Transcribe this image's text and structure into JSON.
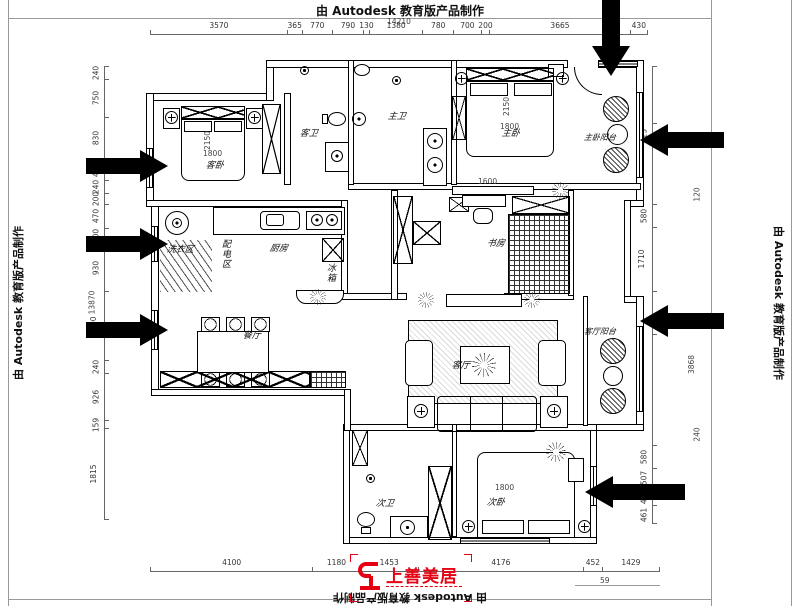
{
  "banner": {
    "top": "由 Autodesk 教育版产品制作",
    "left": "由 Autodesk 教育版产品制作",
    "right": "由 Autodesk 教育版产品制作",
    "bottom": "由 Autodesk 教育版产品制作"
  },
  "logo": {
    "text": "上善美居",
    "color": "#e60012"
  },
  "rooms": {
    "guest_bedroom": "客卧",
    "guest_bath": "客卫",
    "master_bath": "主卫",
    "master_bedroom": "主卧",
    "master_balcony": "主卧阳台",
    "study": "书房",
    "power_area": "配电区",
    "laundry": "洗衣区",
    "kitchen": "厨房",
    "fridge": "冰箱",
    "dining": "餐厅",
    "living": "客厅",
    "living_balcony": "客厅阳台",
    "second_bath": "次卫",
    "second_bedroom": "次卧"
  },
  "dims": {
    "top_total": "14210",
    "top": [
      "3570",
      "365",
      "770",
      "790",
      "130",
      "1380",
      "780",
      "700",
      "200",
      "3665",
      "430"
    ],
    "bottom": [
      "4100",
      "1180",
      "1453",
      "4176",
      "452",
      "1429"
    ],
    "bottom_sub": "59",
    "left_total": "13870",
    "left": [
      "240",
      "750",
      "830",
      "410",
      "240",
      "200",
      "470",
      "300",
      "930",
      "1390",
      "240",
      "926",
      "159",
      "1815"
    ],
    "right": [
      "1530",
      "623",
      "1530",
      "580",
      "1710",
      "1145",
      "3010",
      "580",
      "507",
      "451",
      "461"
    ],
    "right_outer": {
      "a": "120",
      "b": "3868",
      "c": "240"
    }
  },
  "furniture_dims": {
    "guest_bed_l": "2150",
    "guest_bed_w": "1800",
    "master_bed_l": "2150",
    "master_bed_w": "1800",
    "tv_cabinet": "1600",
    "second_bed_w": "1800"
  },
  "icons": {
    "plant-icon": "css-starburst",
    "potted-plant-icon": "css-hatched-circle",
    "flower-icon": "css-cross-circle",
    "ceiling-light-icon": "css-dot-circle",
    "arrow-icon": "css-solid-arrow"
  }
}
